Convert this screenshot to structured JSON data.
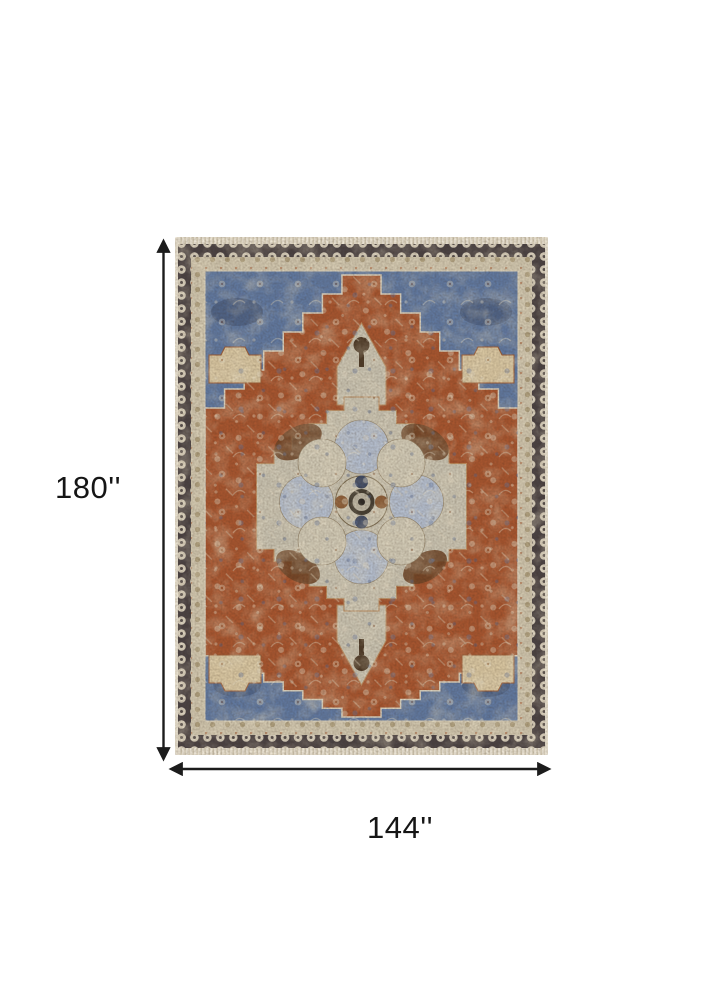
{
  "page": {
    "background_color": "#ffffff"
  },
  "diagram": {
    "subject": "area rug with persian medallion pattern",
    "height_label": "180''",
    "width_label": "144''",
    "arrow_color": "#1c1c1c",
    "label_color": "#151515",
    "rug_palette": {
      "fringe_ivory": "#e9e2d2",
      "border_charcoal": "#4a4243",
      "rosette_ivory": "#d9d0bd",
      "guard_tan": "#cfc5ad",
      "corner_blue": "#60789f",
      "field_rust": "#a6552f",
      "medallion_ivory": "#c8c2b0",
      "accent_tan": "#d7c5a0",
      "accent_brown": "#6d4426",
      "accent_navy": "#3d4d6e"
    }
  }
}
